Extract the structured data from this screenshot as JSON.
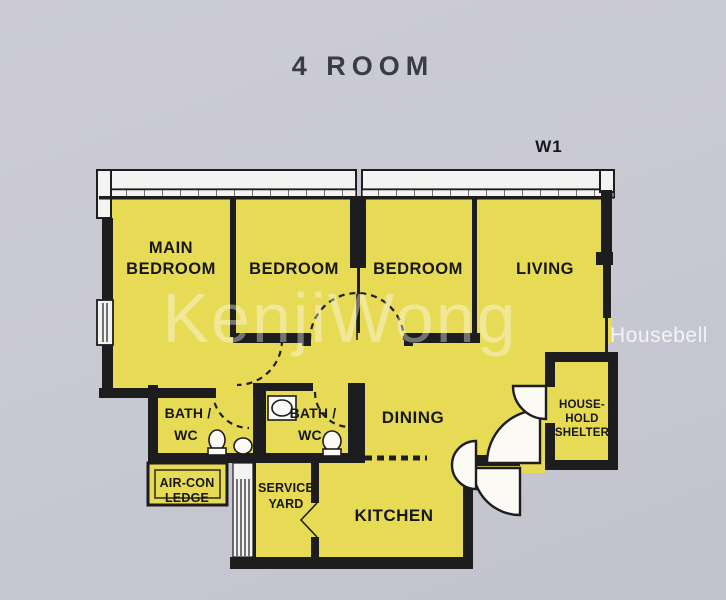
{
  "title": "4 ROOM",
  "unit_label": "W1",
  "watermarks": {
    "center": "KenjiWong",
    "right": "Housebell"
  },
  "rooms": {
    "main_bedroom": {
      "lines": [
        "MAIN",
        "BEDROOM"
      ]
    },
    "bedroom_2": {
      "label": "BEDROOM"
    },
    "bedroom_3": {
      "label": "BEDROOM"
    },
    "living": {
      "label": "LIVING"
    },
    "bath_1": {
      "lines": [
        "BATH /",
        "WC"
      ]
    },
    "bath_2": {
      "lines": [
        "BATH /",
        "WC"
      ]
    },
    "dining": {
      "label": "DINING"
    },
    "kitchen": {
      "label": "KITCHEN"
    },
    "service_yard": {
      "lines": [
        "SERVICE",
        "YARD"
      ]
    },
    "aircon_ledge": {
      "lines": [
        "AIR-CON",
        "LEDGE"
      ]
    },
    "household_shelter": {
      "lines": [
        "HOUSE-",
        "HOLD",
        "SHELTER"
      ]
    }
  },
  "colors": {
    "page_bg": "#c9c9d3",
    "floor": "#e7da55",
    "wall": "#1d1d1f",
    "band": "#f4f3f1",
    "ink": "#17171a",
    "title_ink": "#363d44"
  }
}
